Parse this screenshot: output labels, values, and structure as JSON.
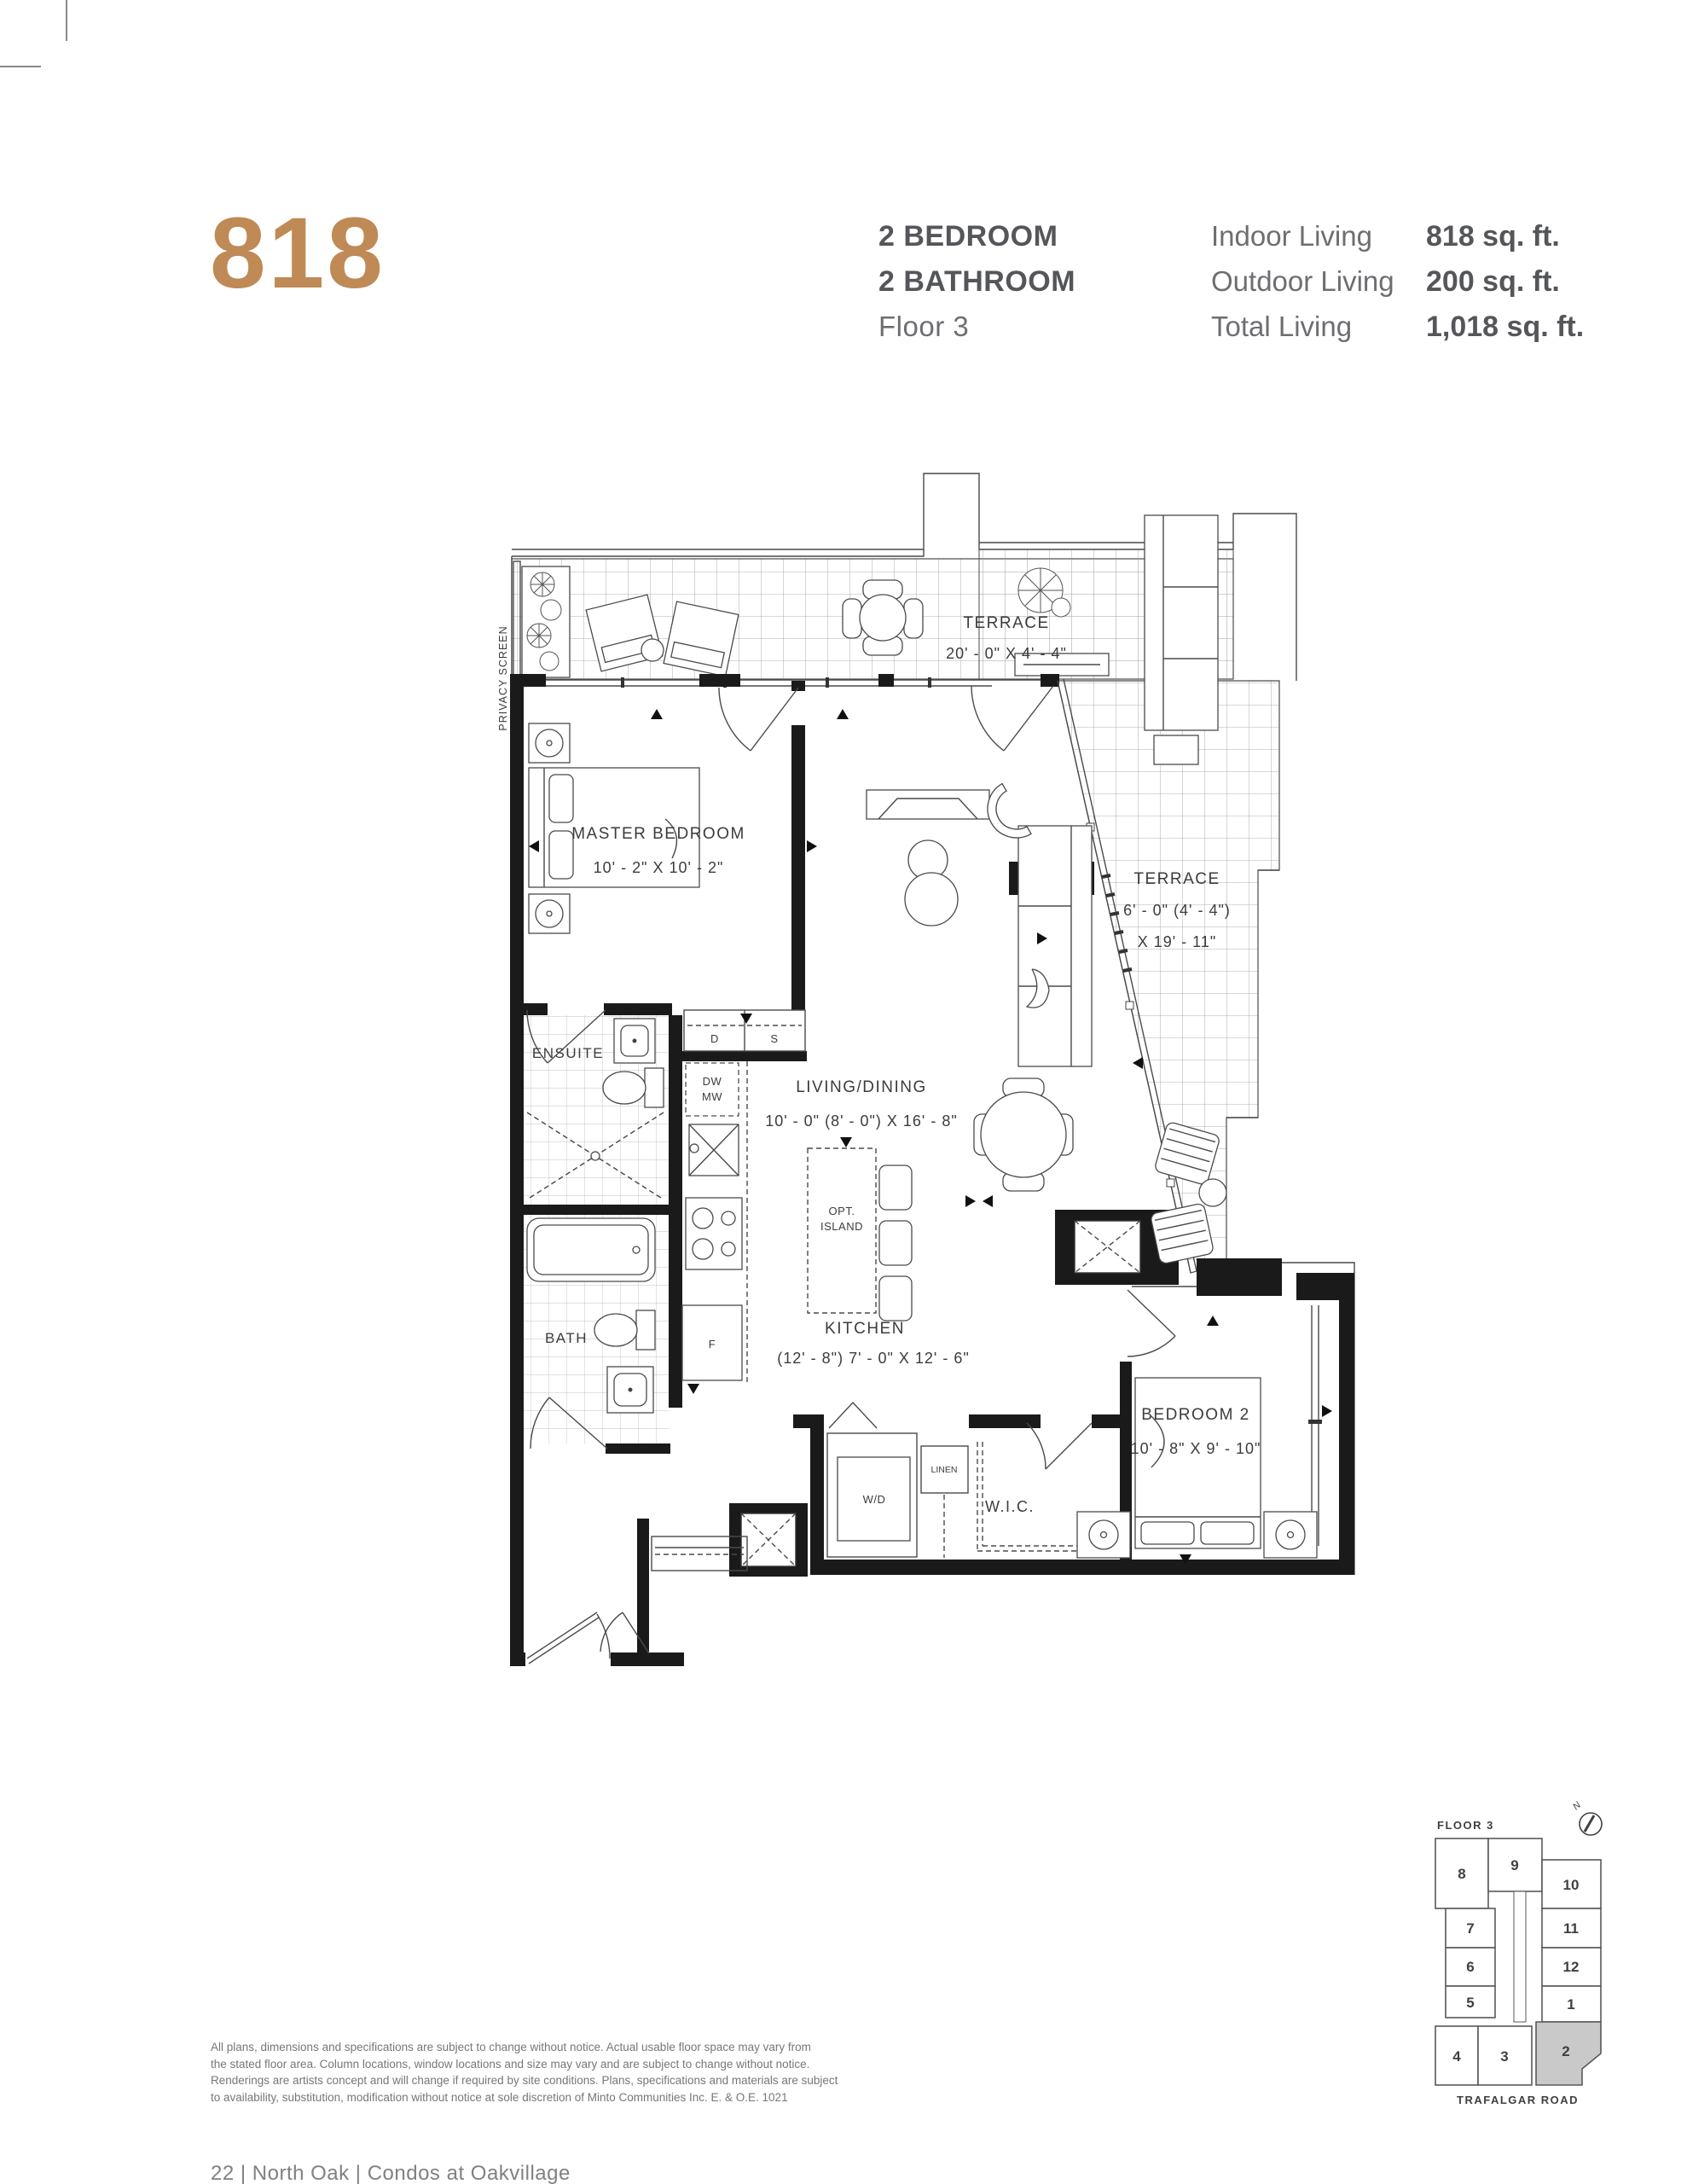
{
  "page": {
    "footer": "22   |   North Oak | Condos at Oakvillage"
  },
  "header": {
    "unit_number": "818",
    "accent_color": "#bf8a55",
    "specs": [
      "2 BEDROOM",
      "2 BATHROOM",
      "Floor 3"
    ],
    "stats": [
      {
        "label": "Indoor Living",
        "value": "818 sq. ft."
      },
      {
        "label": "Outdoor Living",
        "value": "200 sq. ft."
      },
      {
        "label": "Total Living",
        "value": "1,018 sq. ft."
      }
    ]
  },
  "floorplan": {
    "privacy_screen": "PRIVACY SCREEN",
    "terrace_top": {
      "name": "TERRACE",
      "dims": "20' - 0\" X 4' - 4\""
    },
    "master": {
      "name": "MASTER BEDROOM",
      "dims": "10' - 2\" X 10' - 2\""
    },
    "ensuite": {
      "name": "ENSUITE"
    },
    "bath": {
      "name": "BATH"
    },
    "living": {
      "name": "LIVING/DINING",
      "dims": "10' - 0\" (8' - 0\") X 16' - 8\""
    },
    "kitchen": {
      "name": "KITCHEN",
      "dims": "(12' - 8\") 7' - 0\" X 12' - 6\""
    },
    "terrace_right": {
      "name": "TERRACE",
      "dims1": "6' - 0\" (4' - 4\")",
      "dims2": "X 19' - 11\""
    },
    "bedroom2": {
      "name": "BEDROOM 2",
      "dims": "10' - 8\" X 9' - 10\""
    },
    "wic": "W.I.C.",
    "wd": "W/D",
    "linen": "LINEN",
    "step": "STEP",
    "dw": "DW",
    "mw": "MW",
    "closet_d": "D",
    "closet_s": "S",
    "fridge": "F",
    "island1": "OPT.",
    "island2": "ISLAND"
  },
  "keyplan": {
    "title": "FLOOR 3",
    "north": "N",
    "street": "TRAFALGAR ROAD",
    "units": [
      "8",
      "9",
      "10",
      "7",
      "11",
      "6",
      "12",
      "5",
      "1",
      "4",
      "3",
      "2"
    ],
    "highlighted_unit": "2",
    "highlight_color": "#c9c9c9"
  },
  "disclaimer": [
    "All plans, dimensions and specifications are subject to change without notice. Actual usable floor space may vary from",
    "the stated floor area. Column locations, window locations and size may vary and are subject to change without notice.",
    "Renderings are artists concept and will change if required by site conditions. Plans, specifications and materials are subject",
    "to availability, substitution, modification without notice at sole discretion of Minto Communities Inc.   E. & O.E. 1021"
  ]
}
